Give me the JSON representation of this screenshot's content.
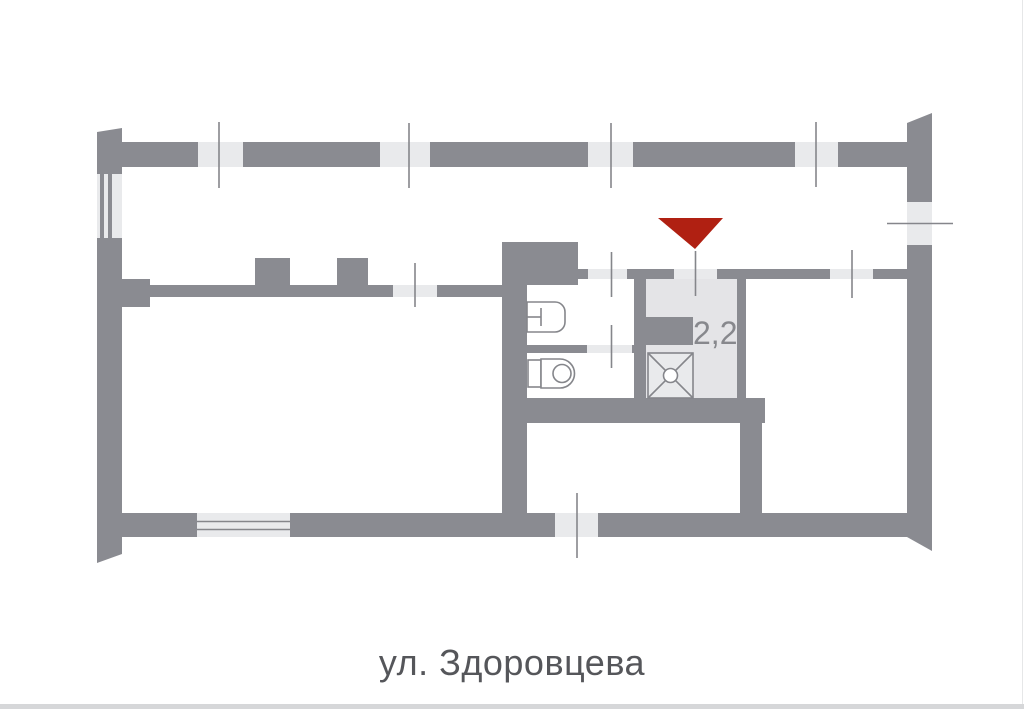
{
  "caption": {
    "text": "ул. Здоровцева"
  },
  "plan": {
    "area_label": "2,2"
  },
  "icons": {
    "marker": "triangle-down-marker",
    "fixtures": [
      "sink-icon",
      "toilet-icon",
      "shower-icon"
    ],
    "window": "window-opening",
    "door": "door-opening"
  },
  "colors": {
    "page_bg": "#ffffff",
    "wall": "#8a8b91",
    "opening": "#e9eaec",
    "room_fill": "#e4e4e7",
    "line": "#85868b",
    "fixture_fill": "#ffffff",
    "marker": "#b02012",
    "area_label": "#87888d",
    "caption": "#55565a",
    "edge": "#d6d7d9"
  }
}
